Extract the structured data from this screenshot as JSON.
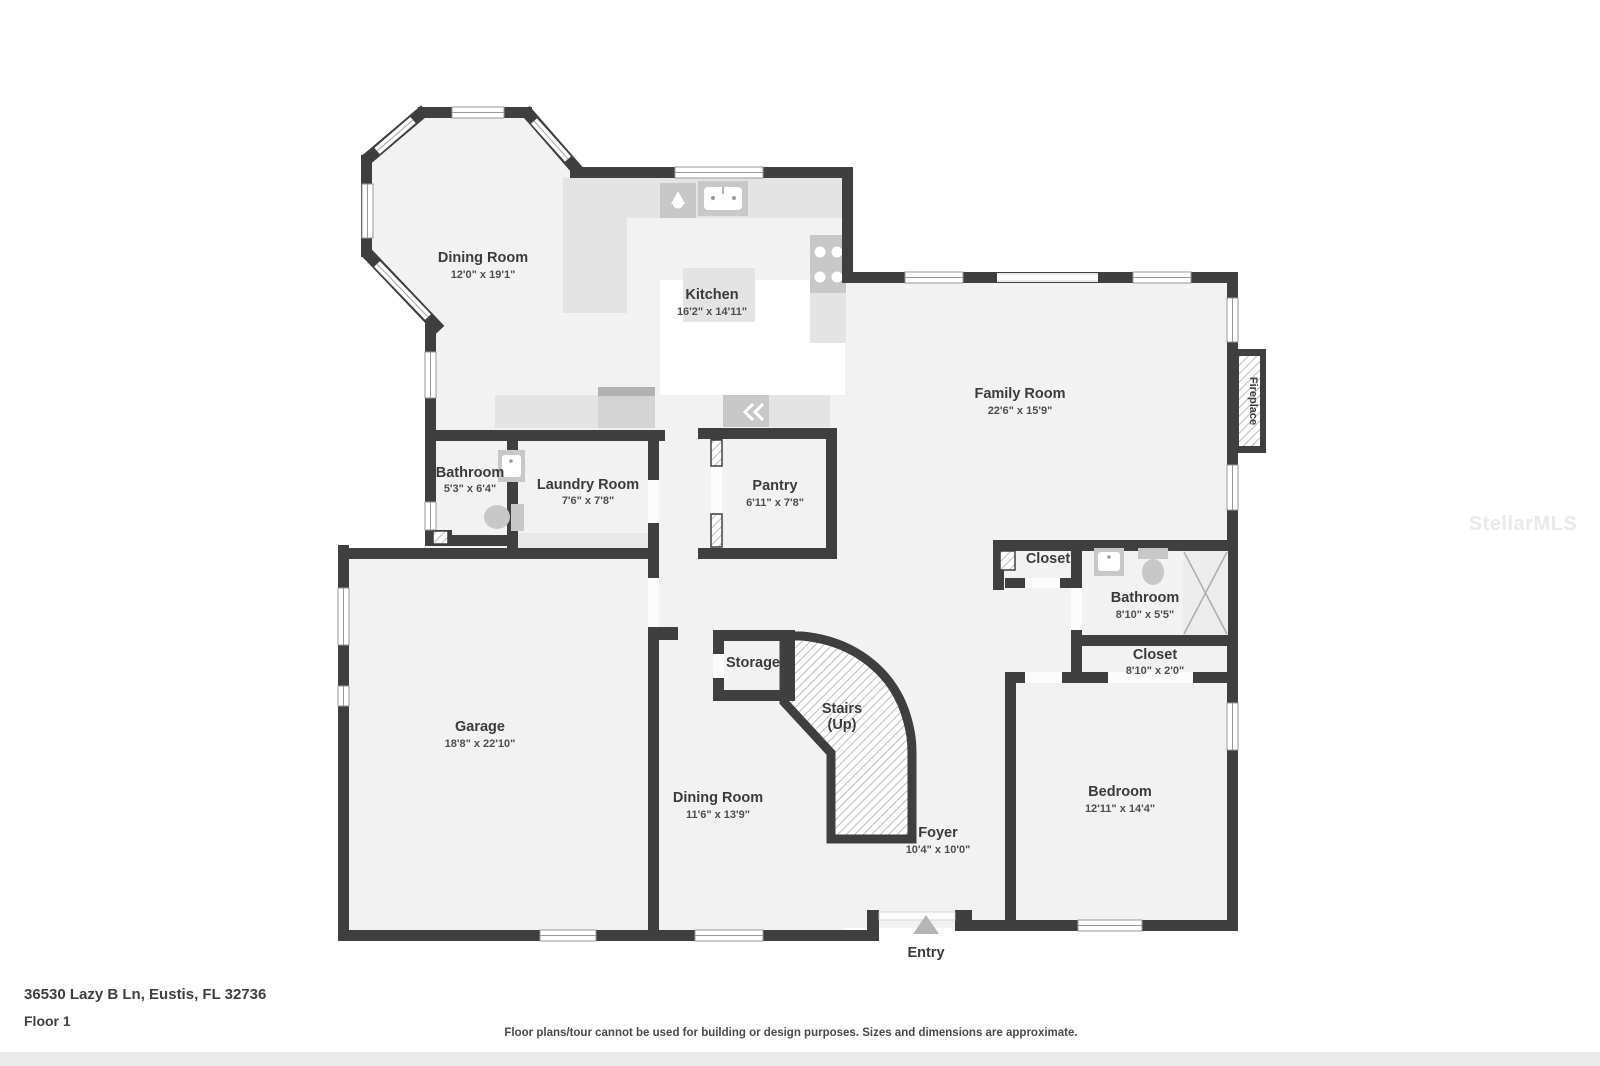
{
  "page": {
    "address": "36530 Lazy B Ln, Eustis, FL 32736",
    "floor_label": "Floor 1",
    "disclaimer": "Floor plans/tour cannot be used for building or design purposes. Sizes and dimensions are approximate.",
    "watermark": "StellarMLS"
  },
  "colors": {
    "wall": "#3f3f3f",
    "floor": "#f2f2f2",
    "counter": "#e4e4e4",
    "appliance": "#c8c8c8",
    "label": "#3b3b3b",
    "dims": "#4f4f4f",
    "watermark": "#eaeaea"
  },
  "rooms": {
    "dining_top": {
      "name": "Dining Room",
      "dims": "12'0\" x 19'1\""
    },
    "kitchen": {
      "name": "Kitchen",
      "dims": "16'2\" x 14'11\""
    },
    "family": {
      "name": "Family Room",
      "dims": "22'6\" x 15'9\""
    },
    "bathroom_left": {
      "name": "Bathroom",
      "dims": "5'3\" x 6'4\""
    },
    "laundry": {
      "name": "Laundry Room",
      "dims": "7'6\" x 7'8\""
    },
    "pantry": {
      "name": "Pantry",
      "dims": "6'11\" x 7'8\""
    },
    "closet_hall": {
      "name": "Closet"
    },
    "bathroom_right": {
      "name": "Bathroom",
      "dims": "8'10\" x 5'5\""
    },
    "closet_bedroom": {
      "name": "Closet",
      "dims": "8'10\" x 2'0\""
    },
    "garage": {
      "name": "Garage",
      "dims": "18'8\" x 22'10\""
    },
    "storage": {
      "name": "Storage"
    },
    "stairs": {
      "line1": "Stairs",
      "line2": "(Up)"
    },
    "dining_bottom": {
      "name": "Dining Room",
      "dims": "11'6\" x 13'9\""
    },
    "foyer": {
      "name": "Foyer",
      "dims": "10'4\" x 10'0\""
    },
    "bedroom": {
      "name": "Bedroom",
      "dims": "12'11\" x 14'4\""
    },
    "entry": {
      "name": "Entry"
    },
    "fireplace": {
      "label": "Fireplace"
    }
  }
}
